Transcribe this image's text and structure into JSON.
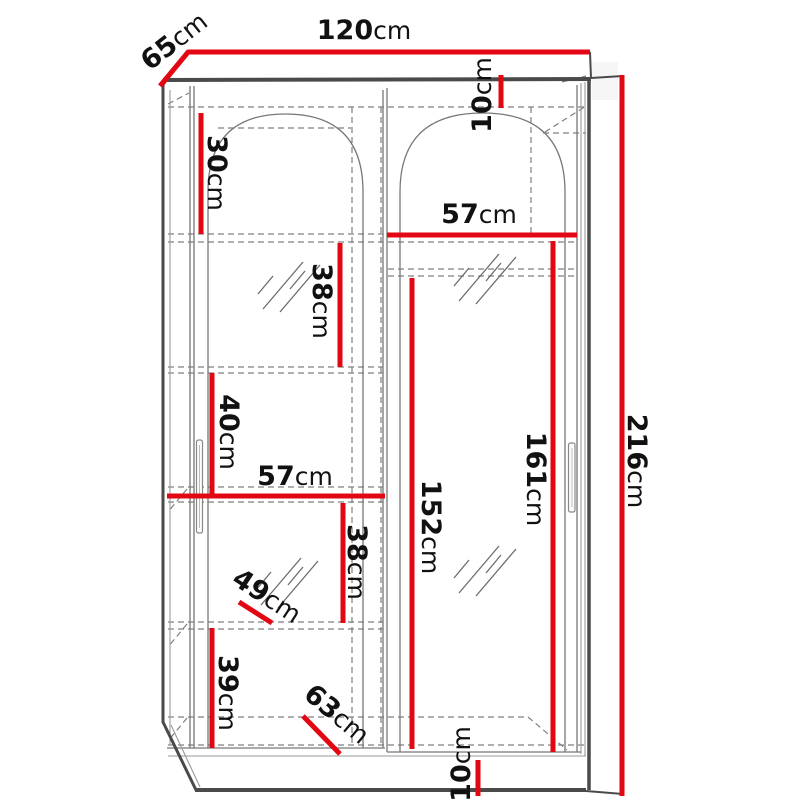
{
  "diagram": {
    "title": "wardrobe-dimension-drawing",
    "subject": "Two-door sliding wardrobe with arched door panels, front 3D view, interior shelves shown dashed",
    "unit": "cm",
    "colors": {
      "dimension_line": "#e30613",
      "outline": "#4a4a4a",
      "hidden_line": "#7f7f7f",
      "label_text": "#111111",
      "background": "#ffffff"
    },
    "dimensions": [
      {
        "name": "total-width",
        "value": "120",
        "unit": "cm",
        "line": {
          "x1": 188,
          "y1": 52,
          "x2": 590,
          "y2": 52
        },
        "label": {
          "x": 364,
          "y": 30,
          "rotate": 0
        }
      },
      {
        "name": "depth",
        "value": "65",
        "unit": "cm",
        "line": {
          "x1": 160,
          "y1": 86,
          "x2": 189,
          "y2": 51
        },
        "label": {
          "x": 174,
          "y": 41,
          "rotate": -38
        }
      },
      {
        "name": "top-panel-height",
        "value": "10",
        "unit": "cm",
        "line": {
          "x1": 501,
          "y1": 75,
          "x2": 501,
          "y2": 108
        },
        "label": {
          "x": 482,
          "y": 95,
          "rotate": -90
        }
      },
      {
        "name": "top-shelf-height",
        "value": "30",
        "unit": "cm",
        "line": {
          "x1": 201,
          "y1": 113,
          "x2": 201,
          "y2": 234
        },
        "label": {
          "x": 217,
          "y": 173,
          "rotate": 90
        }
      },
      {
        "name": "right-section-width",
        "value": "57",
        "unit": "cm",
        "line": {
          "x1": 387,
          "y1": 235,
          "x2": 577,
          "y2": 235
        },
        "label": {
          "x": 479,
          "y": 214,
          "rotate": 0
        }
      },
      {
        "name": "shelf-height-upper",
        "value": "38",
        "unit": "cm",
        "line": {
          "x1": 340,
          "y1": 243,
          "x2": 340,
          "y2": 367
        },
        "label": {
          "x": 322,
          "y": 301,
          "rotate": 90
        }
      },
      {
        "name": "shelf-height-mid",
        "value": "40",
        "unit": "cm",
        "line": {
          "x1": 212,
          "y1": 373,
          "x2": 212,
          "y2": 496
        },
        "label": {
          "x": 229,
          "y": 432,
          "rotate": 90
        }
      },
      {
        "name": "left-section-width",
        "value": "57",
        "unit": "cm",
        "line": {
          "x1": 167,
          "y1": 496,
          "x2": 385,
          "y2": 496
        },
        "label": {
          "x": 295,
          "y": 476,
          "rotate": 0
        }
      },
      {
        "name": "shelf-height-lower",
        "value": "38",
        "unit": "cm",
        "line": {
          "x1": 343,
          "y1": 503,
          "x2": 343,
          "y2": 623
        },
        "label": {
          "x": 357,
          "y": 562,
          "rotate": 90
        }
      },
      {
        "name": "shelf-depth",
        "value": "49",
        "unit": "cm",
        "line": {
          "x1": 239,
          "y1": 602,
          "x2": 272,
          "y2": 623
        },
        "label": {
          "x": 267,
          "y": 596,
          "rotate": 33
        }
      },
      {
        "name": "bottom-shelf-height",
        "value": "39",
        "unit": "cm",
        "line": {
          "x1": 212,
          "y1": 628,
          "x2": 212,
          "y2": 748
        },
        "label": {
          "x": 228,
          "y": 693,
          "rotate": 90
        }
      },
      {
        "name": "bottom-depth",
        "value": "63",
        "unit": "cm",
        "line": {
          "x1": 303,
          "y1": 716,
          "x2": 340,
          "y2": 754
        },
        "label": {
          "x": 337,
          "y": 714,
          "rotate": 40
        }
      },
      {
        "name": "hanging-height",
        "value": "152",
        "unit": "cm",
        "line": {
          "x1": 412,
          "y1": 278,
          "x2": 412,
          "y2": 749
        },
        "label": {
          "x": 431,
          "y": 527,
          "rotate": 90
        }
      },
      {
        "name": "door-panel-height",
        "value": "161",
        "unit": "cm",
        "line": {
          "x1": 553,
          "y1": 241,
          "x2": 553,
          "y2": 752
        },
        "label": {
          "x": 536,
          "y": 479,
          "rotate": 90
        }
      },
      {
        "name": "total-height",
        "value": "216",
        "unit": "cm",
        "line": {
          "x1": 622,
          "y1": 75,
          "x2": 622,
          "y2": 796
        },
        "label": {
          "x": 637,
          "y": 461,
          "rotate": 90
        }
      },
      {
        "name": "base-height",
        "value": "10",
        "unit": "cm",
        "line": {
          "x1": 478,
          "y1": 760,
          "x2": 478,
          "y2": 796
        },
        "label": {
          "x": 461,
          "y": 764,
          "rotate": -90
        }
      }
    ]
  }
}
